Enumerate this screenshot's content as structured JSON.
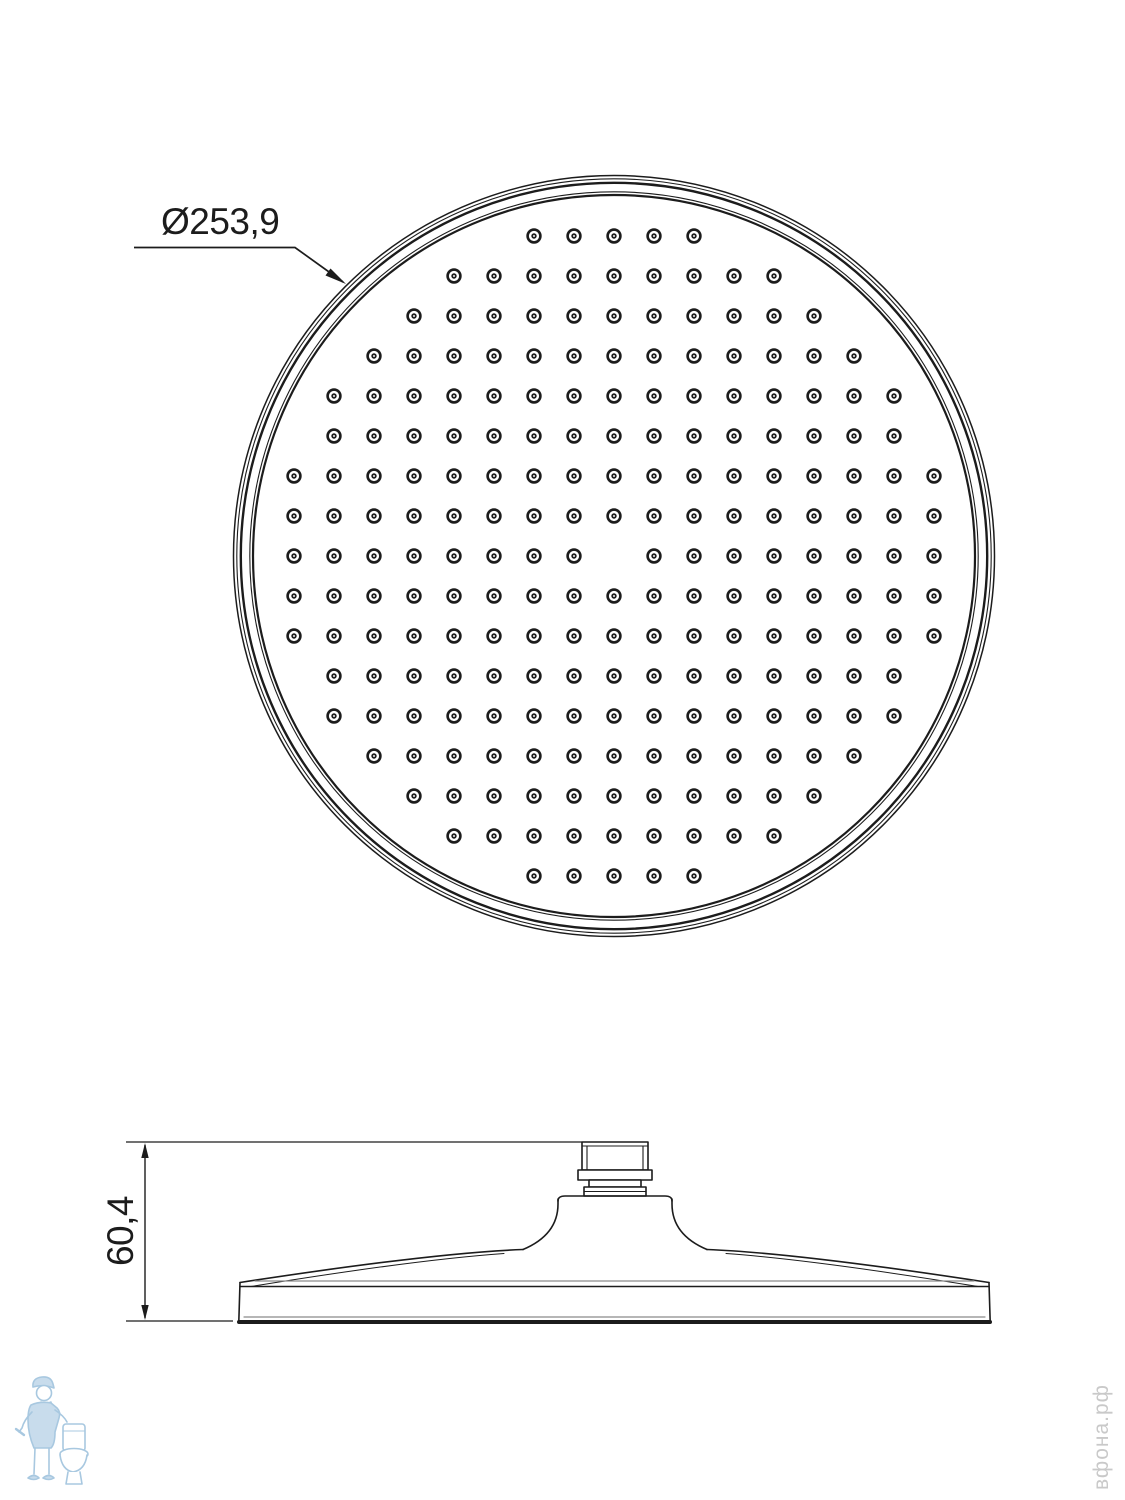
{
  "line_color": "#1c1c1c",
  "light_line_color": "#8a8a8a",
  "top_view": {
    "diameter_label": "Ø253,9",
    "center_x": 614,
    "center_y": 556,
    "rim_circles": [
      {
        "r": 380.5,
        "w": 1.5
      },
      {
        "r": 377.2,
        "w": 1.1
      },
      {
        "r": 373.2,
        "w": 2.4
      },
      {
        "r": 364.2,
        "w": 1.1
      },
      {
        "r": 361.0,
        "w": 2.2
      }
    ],
    "nozzle_grid": {
      "spacing": 40,
      "inclusion_radius": 335,
      "missing": [
        [
          0,
          0
        ]
      ],
      "style": {
        "outer_r": 6.4,
        "ring_w": 2.6,
        "dot_r": 2.7,
        "pin_r": 0.95
      }
    }
  },
  "side_view": {
    "height_label": "60,4"
  },
  "watermark": {
    "logo_name": "plumber-and-toilet-logo",
    "logo_color": "#a8c8e0",
    "logo_fill": "#c8dcec",
    "site_text": "вфона.рф",
    "text_color": "#c9c9c9"
  }
}
